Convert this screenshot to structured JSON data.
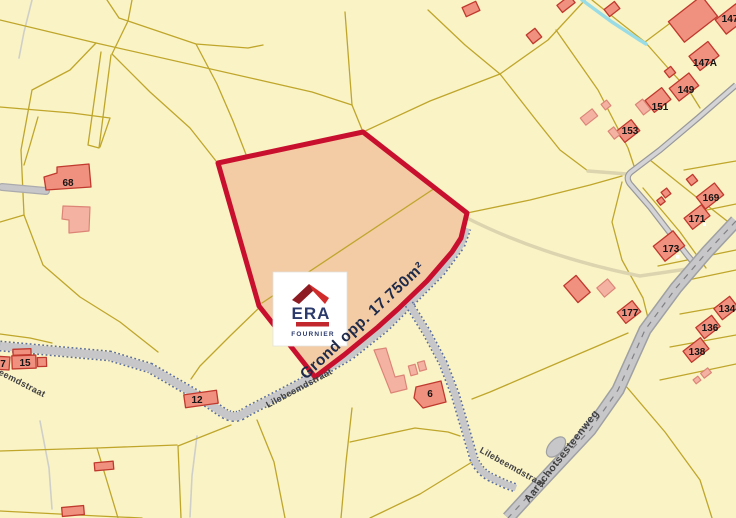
{
  "map": {
    "highlighted_parcel": {
      "area_label": "Grond opp. 17.750m²"
    },
    "logo": {
      "brand": "ERA",
      "subtitle": "FOURNIER"
    },
    "streets": {
      "lilebeemdstraat": "Lilebeemdstraat",
      "aarschotsesteenweg": "Aarschotsesteenweg"
    },
    "houses": [
      {
        "label": "68"
      },
      {
        "label": "147"
      },
      {
        "label": "147A"
      },
      {
        "label": "149"
      },
      {
        "label": "151"
      },
      {
        "label": "153"
      },
      {
        "label": "169"
      },
      {
        "label": "171"
      },
      {
        "label": "173"
      },
      {
        "label": "177"
      },
      {
        "label": "134"
      },
      {
        "label": "136"
      },
      {
        "label": "138"
      },
      {
        "label": "15"
      },
      {
        "label": "7"
      },
      {
        "label": "12"
      },
      {
        "label": "6"
      }
    ],
    "colors": {
      "background": "#FAF3C6",
      "parcel_line": "#BFA62B",
      "highlight_fill": "#F3CBA4",
      "highlight_stroke": "#C8102E",
      "building_fill": "#F0907E",
      "building_stroke": "#C0392E",
      "building_light": "#F4B3A2",
      "road_fill": "#C7C7C9",
      "road_edge": "#9FA0A3",
      "road_dotted_edge": "#5B6E9E",
      "stream": "#9ADCE6",
      "logo_navy": "#2B3A6B",
      "logo_red": "#C1272D"
    }
  }
}
